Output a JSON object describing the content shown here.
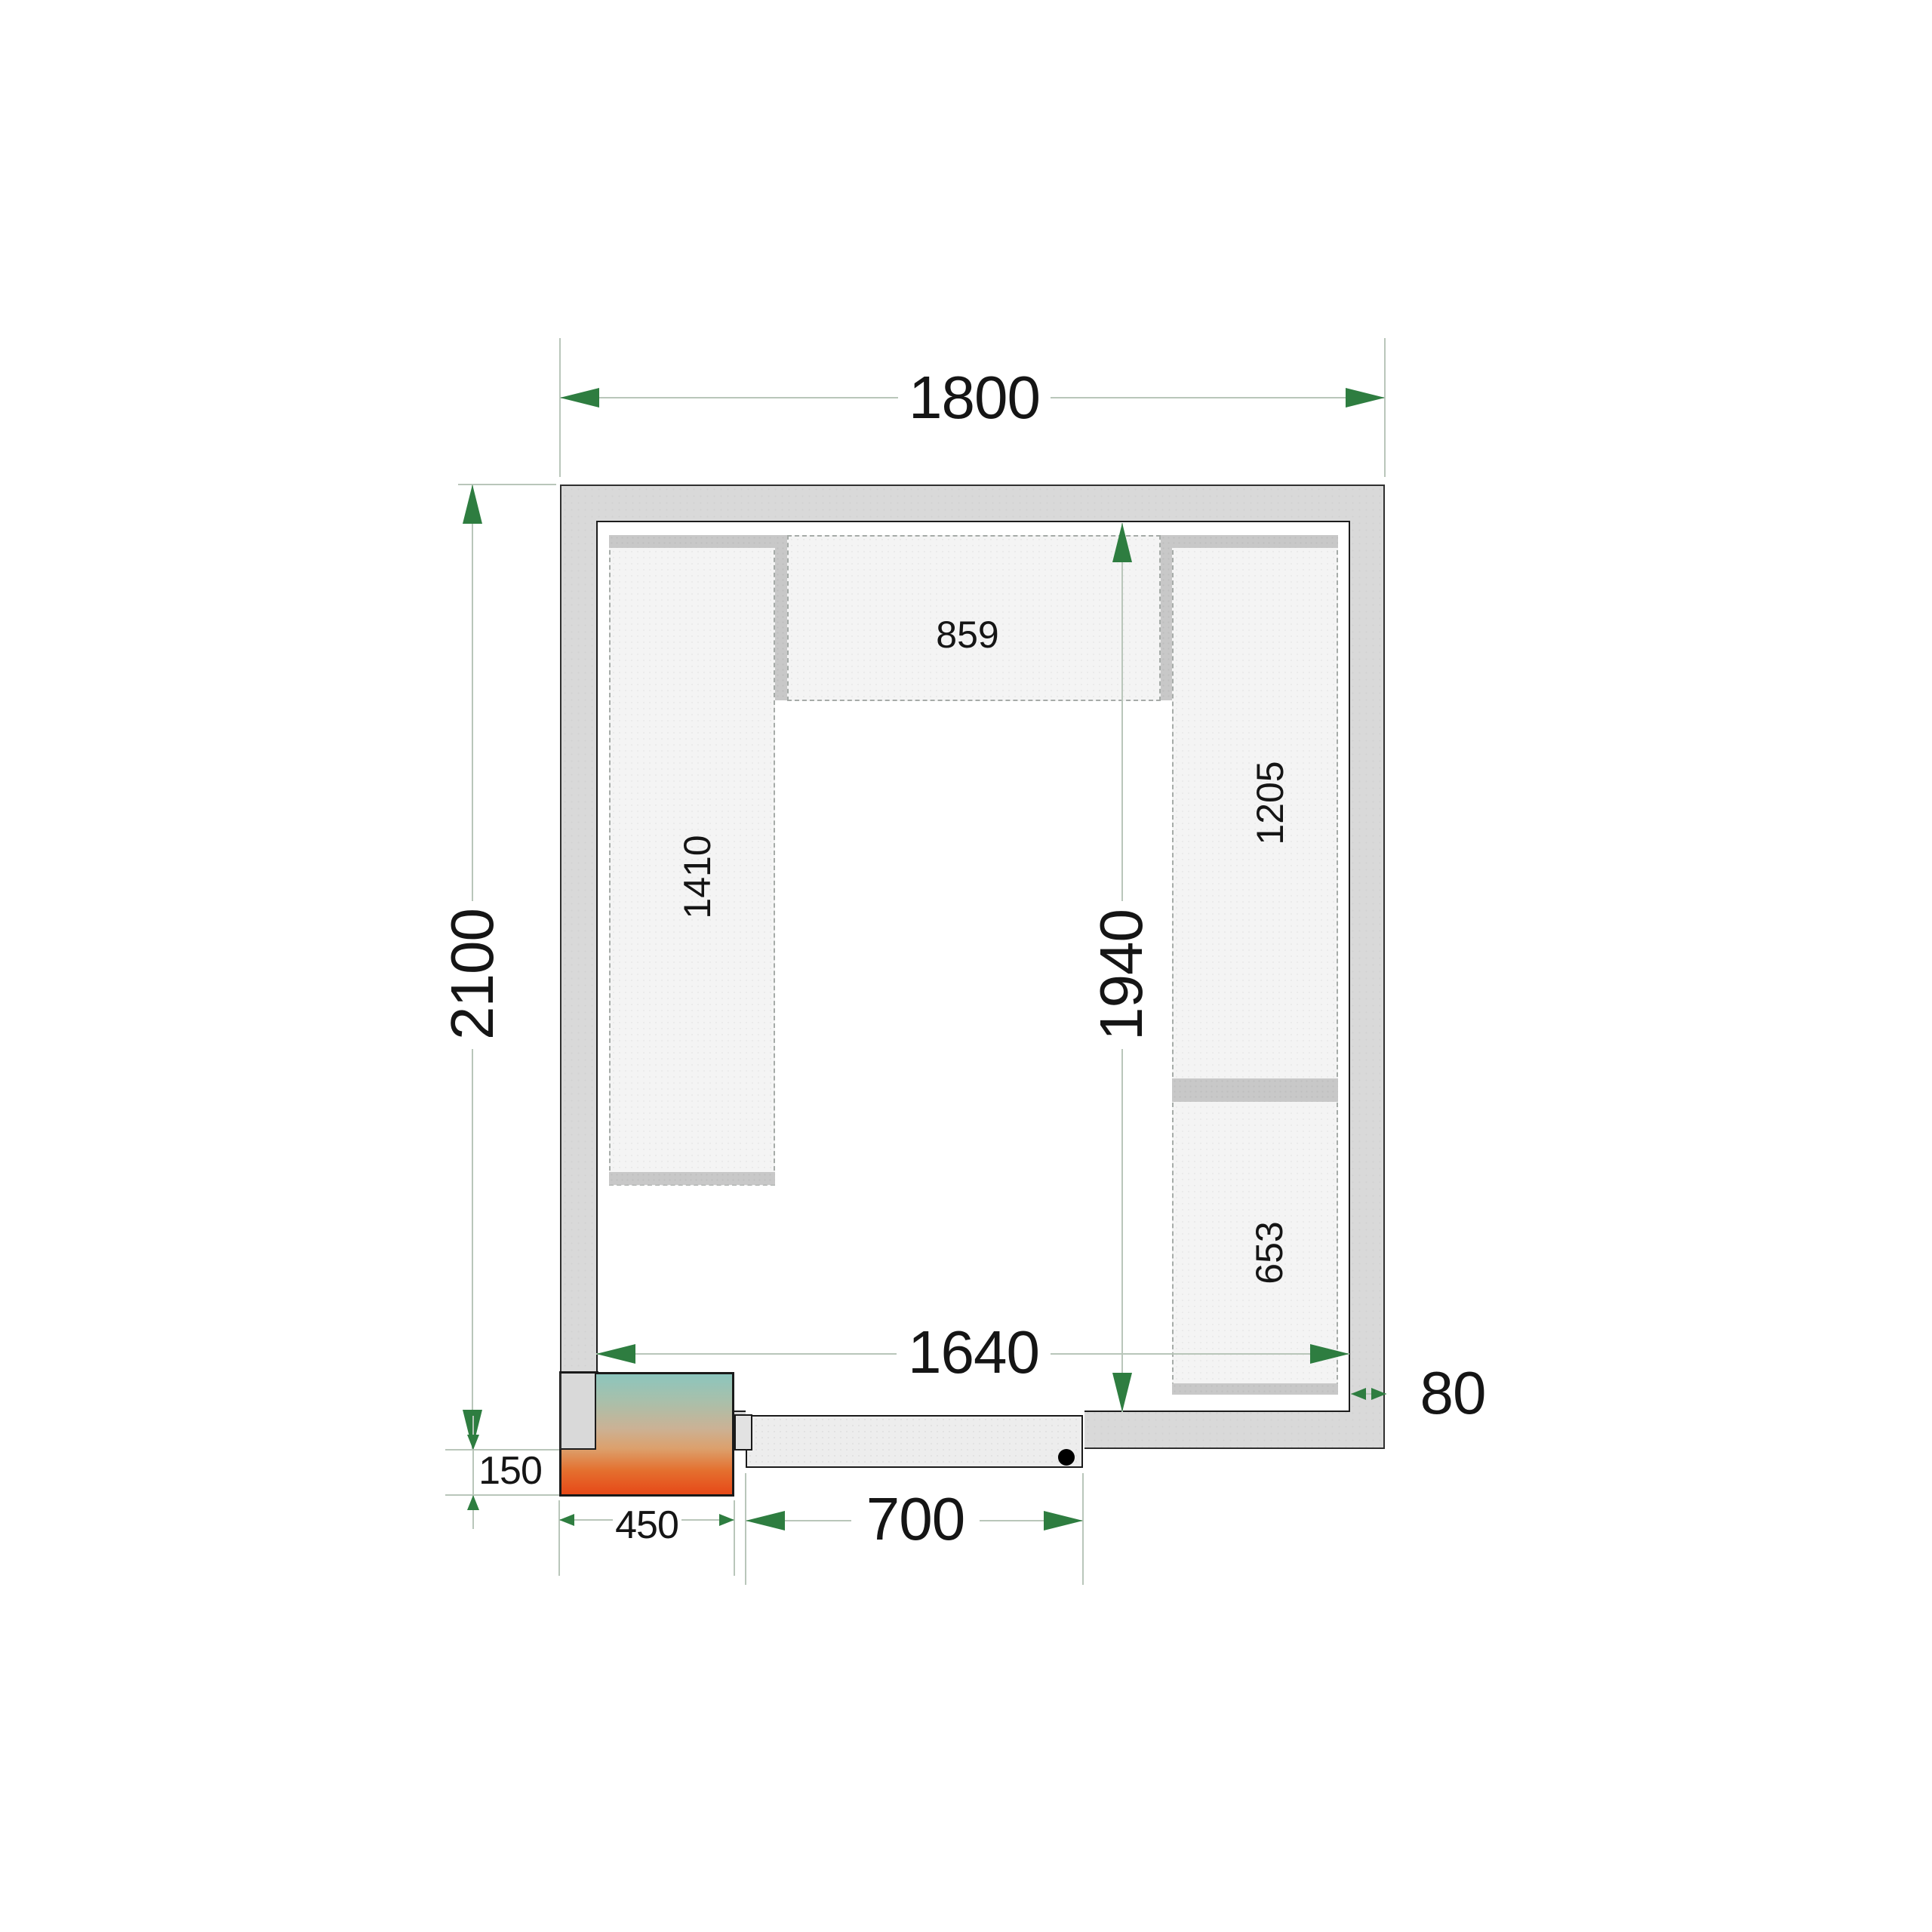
{
  "drawing": {
    "type": "cold-room-floor-plan",
    "dimensions": {
      "outer_width": {
        "label": "1800"
      },
      "outer_height": {
        "label": "2100"
      },
      "inner_width": {
        "label": "1640"
      },
      "inner_height": {
        "label": "1940"
      },
      "wall_thickness": {
        "label": "80"
      },
      "unit_offset": {
        "label": "150"
      },
      "unit_width": {
        "label": "450"
      },
      "door_width": {
        "label": "700"
      }
    },
    "shelves": {
      "top": {
        "label": "859"
      },
      "left": {
        "label": "1410"
      },
      "right_upper": {
        "label": "1205"
      },
      "right_lower": {
        "label": "653"
      }
    },
    "colors": {
      "wall_fill": "#d9d9d9",
      "shelf_fill": "#f4f4f4",
      "shelf_bar": "#c8c8c8",
      "door_fill": "#ededed",
      "dimension_line": "#b9c6ba",
      "arrow": "#2e7d40",
      "text": "#151515",
      "unit_gradient_top": "#8cc5bd",
      "unit_gradient_bottom": "#e74918"
    }
  }
}
